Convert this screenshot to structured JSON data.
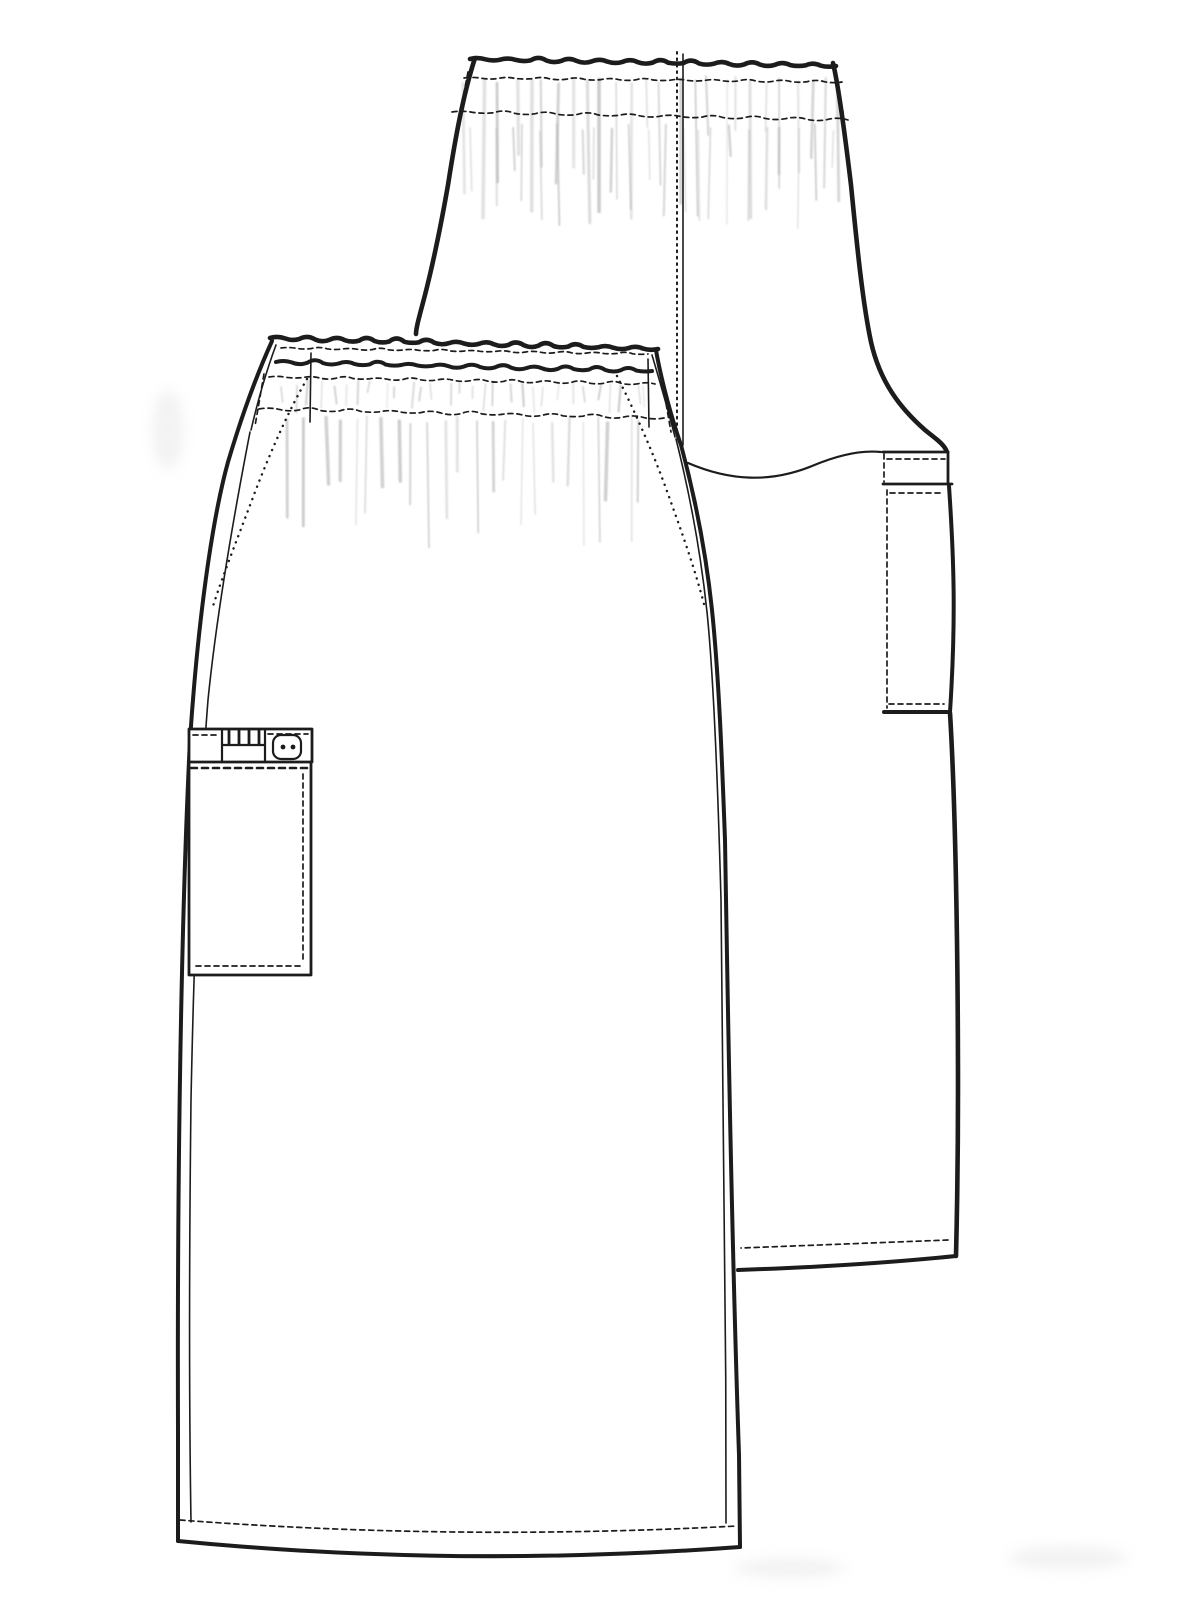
{
  "sketch": {
    "subject": "skirt-technical-flat",
    "views": {
      "front": "front-view",
      "back": "back-view"
    },
    "colors": {
      "background": "#ffffff",
      "fabric": "#ffffff",
      "line": "#1c1c1c",
      "gather_shading": "#b9b9b9"
    },
    "icons": {
      "button": "two-hole-button-icon"
    },
    "features": {
      "waistband": "elasticated-shirred-waistband",
      "front_pocket": "side-cargo-pocket-with-pen-slots-and-button",
      "back_pocket": "side-cargo-pocket-back-view",
      "side_pockets": "slash-pocket-opening-stitching",
      "center_back": "center-back-seam",
      "hem": "topstitched-hem"
    }
  }
}
